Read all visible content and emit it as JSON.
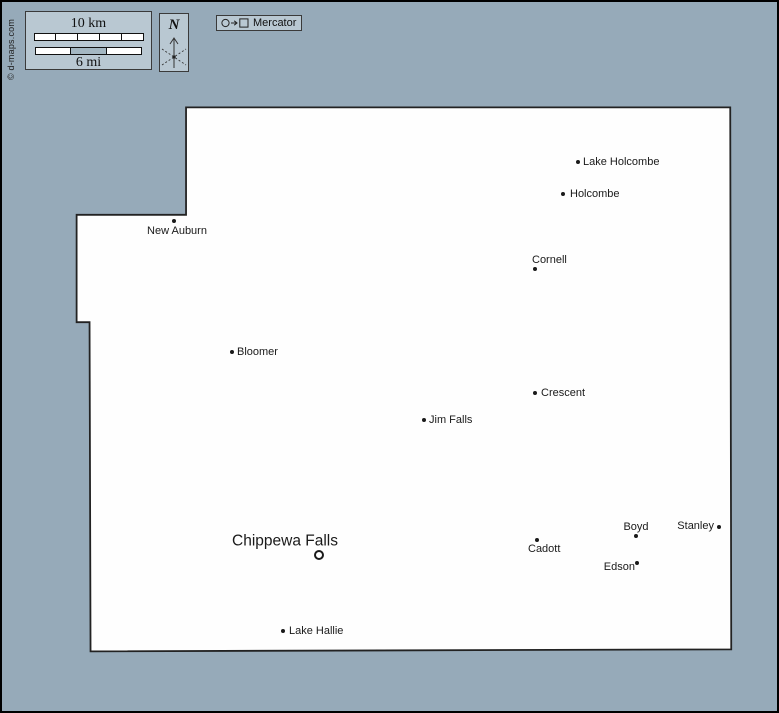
{
  "credit": "© d-maps.com",
  "legend": {
    "scale_km": "10 km",
    "scale_mi": "6 mi",
    "km_segments": 5,
    "mi_segments": 3,
    "mi_shaded_segment": 1,
    "north": "N",
    "projection": "Mercator"
  },
  "colors": {
    "background": "#96aab9",
    "panel": "#b9c8d2",
    "panel_border": "#3a3a3a",
    "county_fill": "#fefefe",
    "outline": "#222222",
    "text": "#1a1a1a",
    "bar_shade": "#a4b7c2",
    "frame": "#000000"
  },
  "county_outline": [
    [
      185,
      106
    ],
    [
      732,
      106
    ],
    [
      733,
      651
    ],
    [
      89,
      653
    ],
    [
      88,
      322
    ],
    [
      75,
      322
    ],
    [
      75,
      214
    ],
    [
      185,
      214
    ]
  ],
  "cities": [
    {
      "name": "Lake Holcombe",
      "dot": [
        576,
        160
      ],
      "label": [
        581,
        160
      ],
      "align": "left"
    },
    {
      "name": "Holcombe",
      "dot": [
        561,
        192
      ],
      "label": [
        568,
        192
      ],
      "align": "left"
    },
    {
      "name": "Cornell",
      "dot": [
        533,
        267
      ],
      "label": [
        530,
        258
      ],
      "align": "left"
    },
    {
      "name": "New Auburn",
      "dot": [
        172,
        219
      ],
      "label": [
        175,
        229
      ],
      "align": "center"
    },
    {
      "name": "Bloomer",
      "dot": [
        230,
        350
      ],
      "label": [
        235,
        350
      ],
      "align": "left"
    },
    {
      "name": "Crescent",
      "dot": [
        533,
        391
      ],
      "label": [
        539,
        391
      ],
      "align": "left"
    },
    {
      "name": "Jim Falls",
      "dot": [
        422,
        418
      ],
      "label": [
        427,
        418
      ],
      "align": "left"
    },
    {
      "name": "Chippewa Falls",
      "dot": [
        317,
        553
      ],
      "label": [
        283,
        539
      ],
      "align": "center",
      "seat": true
    },
    {
      "name": "Cadott",
      "dot": [
        535,
        538
      ],
      "label": [
        526,
        547
      ],
      "align": "left"
    },
    {
      "name": "Boyd",
      "dot": [
        634,
        534
      ],
      "label": [
        634,
        525
      ],
      "align": "center"
    },
    {
      "name": "Stanley",
      "dot": [
        717,
        525
      ],
      "label": [
        712,
        524
      ],
      "align": "right"
    },
    {
      "name": "Edson",
      "dot": [
        635,
        561
      ],
      "label": [
        633,
        565
      ],
      "align": "right"
    },
    {
      "name": "Lake Hallie",
      "dot": [
        281,
        629
      ],
      "label": [
        287,
        629
      ],
      "align": "left"
    }
  ]
}
